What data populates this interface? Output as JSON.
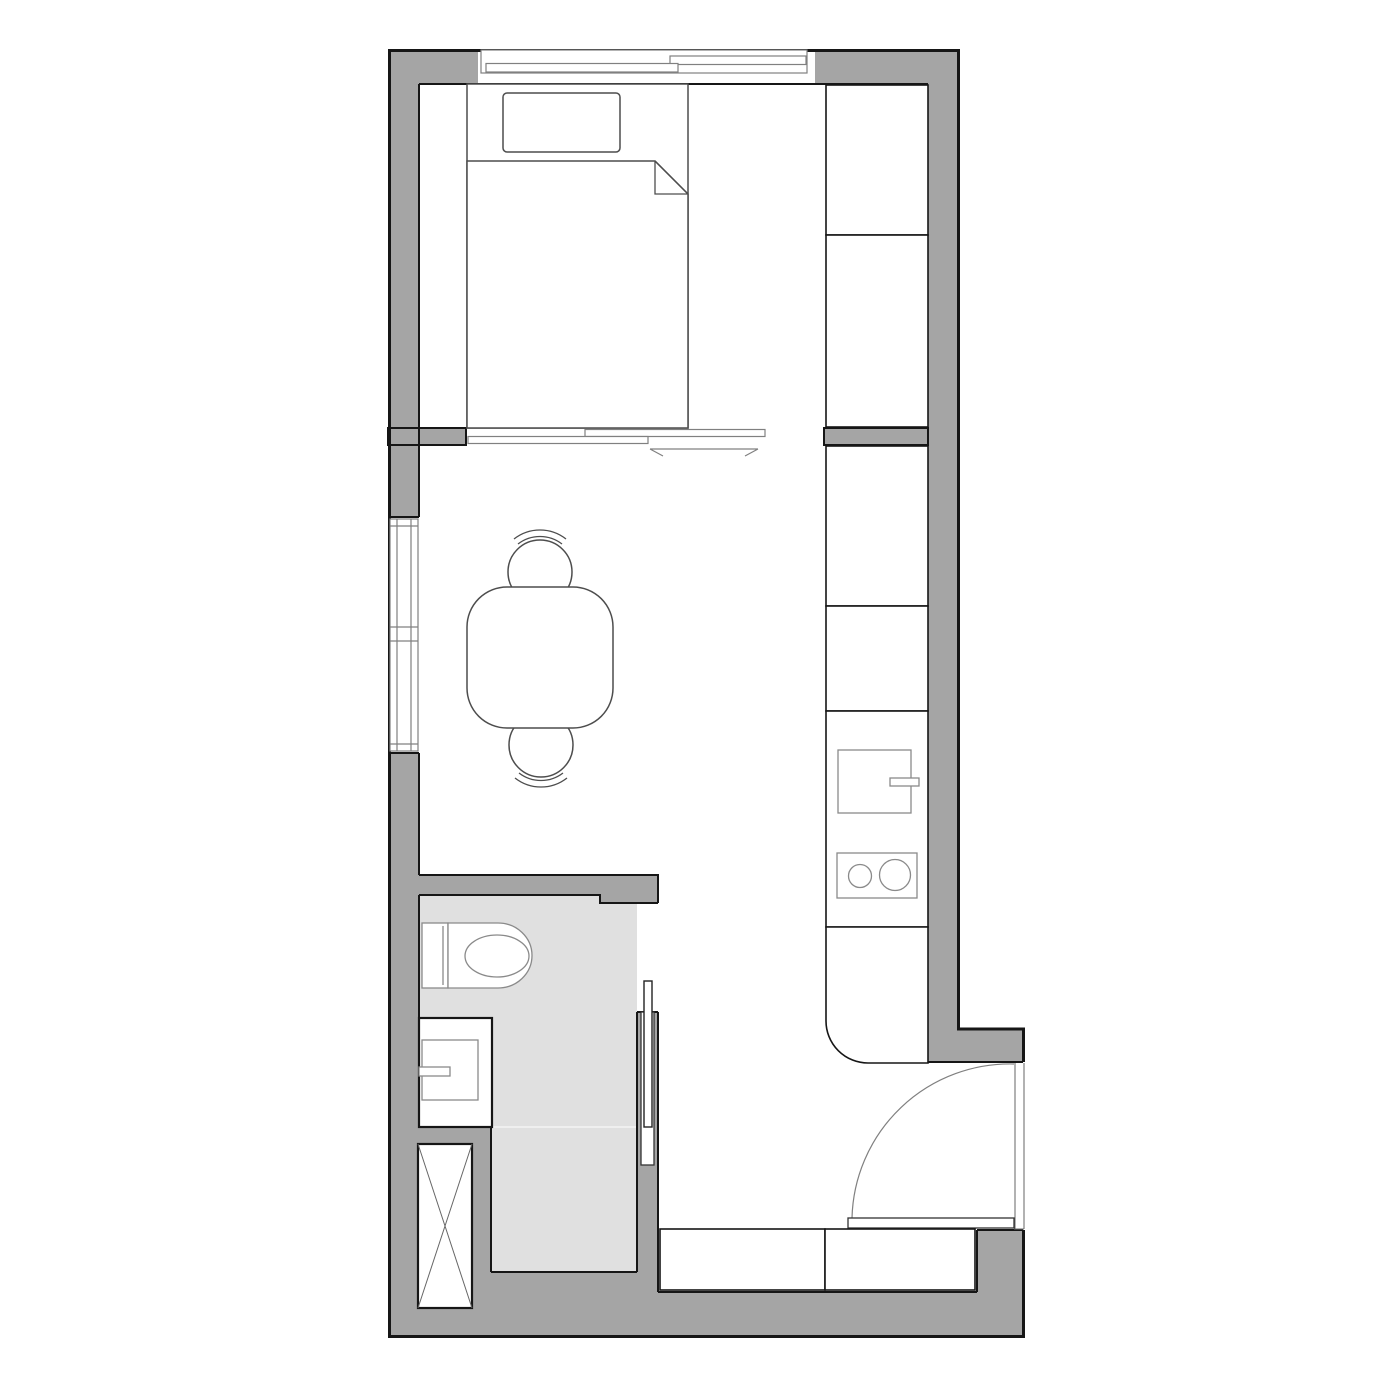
{
  "title": "Studio apartment floor plan",
  "canvas": {
    "width": 1400,
    "height": 1400,
    "background": "#ffffff"
  },
  "colors": {
    "wall": "#a5a5a5",
    "bathroom_floor": "#e0e0e0",
    "outline": "#161616",
    "furniture_line": "#4d4d4d",
    "fixture_line": "#8a8a8a",
    "door_line": "#808080"
  },
  "features": [
    "balcony-sliding-window",
    "double-bed",
    "pillow",
    "duvet-folded-corner",
    "wardrobe-two-sections",
    "sliding-partition-two-panels",
    "slide-direction-arrow",
    "side-window-two-casements",
    "dining-table",
    "chair-north",
    "chair-south",
    "kitchen-tall-unit",
    "kitchen-cabinet",
    "kitchen-counter",
    "kitchen-sink",
    "kitchen-faucet",
    "cooktop-two-burners",
    "rounded-counter-end",
    "bathroom",
    "toilet",
    "washbasin-cabinet",
    "washbasin-faucet",
    "pocket-sliding-door",
    "service-shaft-cross",
    "entry-door-swing",
    "entry-cabinets"
  ]
}
